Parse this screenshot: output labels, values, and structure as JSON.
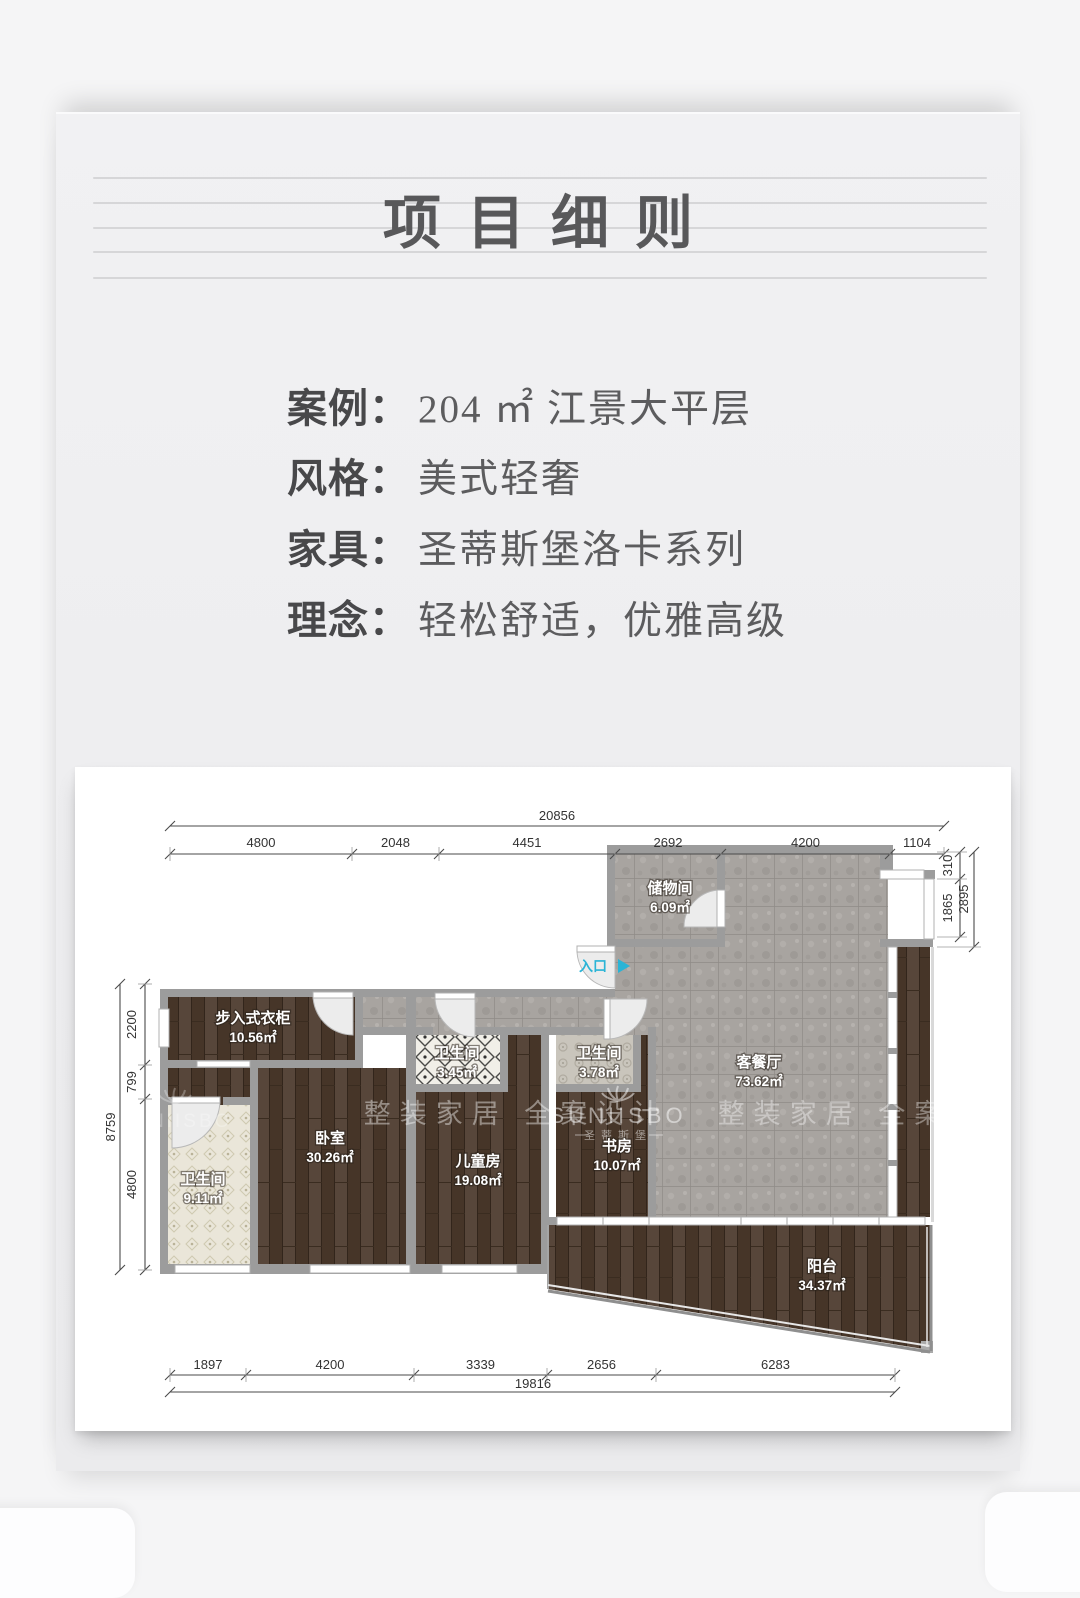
{
  "title": {
    "text": "项目细则"
  },
  "info": {
    "rows": [
      {
        "label": "案例：",
        "value": "204 ㎡ 江景大平层"
      },
      {
        "label": "风格：",
        "value": "美式轻奢"
      },
      {
        "label": "家具：",
        "value": "圣蒂斯堡洛卡系列"
      },
      {
        "label": "理念：",
        "value": "轻松舒适，优雅高级"
      }
    ]
  },
  "floorplan": {
    "entrance": "入口",
    "rooms": [
      {
        "name": "储物间",
        "area": "6.09㎡",
        "x": 595,
        "y": 126
      },
      {
        "name": "客餐厅",
        "area": "73.62㎡",
        "x": 684,
        "y": 300
      },
      {
        "name": "步入式衣柜",
        "area": "10.56㎡",
        "x": 178,
        "y": 256
      },
      {
        "name": "卫生间",
        "area": "3.45㎡",
        "x": 382,
        "y": 291
      },
      {
        "name": "卫生间",
        "area": "3.78㎡",
        "x": 524,
        "y": 291
      },
      {
        "name": "卧室",
        "area": "30.26㎡",
        "x": 255,
        "y": 376
      },
      {
        "name": "儿童房",
        "area": "19.08㎡",
        "x": 403,
        "y": 399
      },
      {
        "name": "书房",
        "area": "10.07㎡",
        "x": 542,
        "y": 384
      },
      {
        "name": "卫生间",
        "area": "9.11㎡",
        "x": 128,
        "y": 417
      },
      {
        "name": "阳台",
        "area": "34.37㎡",
        "x": 747,
        "y": 504
      }
    ],
    "dims": {
      "top": {
        "total": "20856",
        "segments": [
          "4800",
          "2048",
          "4451",
          "2692",
          "4200",
          "1104"
        ]
      },
      "bottom": {
        "total": "19816",
        "segments": [
          "1897",
          "4200",
          "3339",
          "2656",
          "6283"
        ]
      },
      "left": {
        "total": "8759",
        "segments": [
          "2200",
          "799",
          "4800"
        ]
      },
      "right": {
        "total": "2895",
        "segments": [
          "310",
          "1865"
        ]
      }
    },
    "watermark": {
      "brand": "SUNIISBO",
      "brand_cn": "圣蒂斯堡",
      "slogan": "整装家居 全案设计"
    }
  }
}
